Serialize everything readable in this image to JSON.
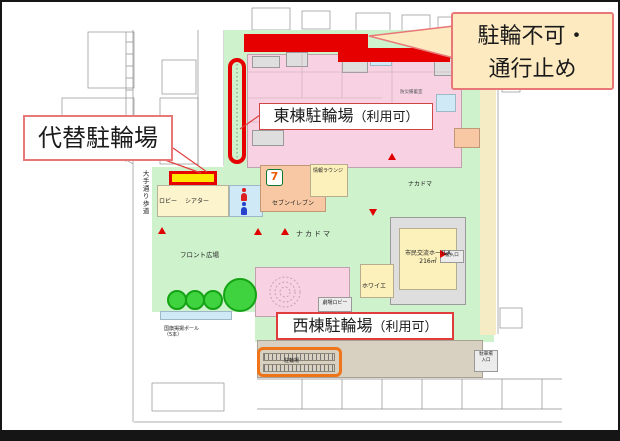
{
  "colors": {
    "alert_red": "#e60000",
    "highlight_yellow": "#ffe600",
    "highlight_orange": "#f07418",
    "callout_bg": "#fdeac1",
    "callout_border": "#e87878",
    "building_pink": "#f8d2e2",
    "ground_green": "#cdf2cc"
  },
  "callouts": {
    "no_parking": {
      "line1": "駐輪不可・",
      "line2": "通行止め"
    },
    "alt_parking": {
      "label": "代替駐輪場"
    },
    "east_parking": {
      "label": "東棟駐輪場",
      "note": "（利用可）"
    },
    "west_parking": {
      "label": "西棟駐輪場",
      "note": "（利用可）"
    }
  },
  "map": {
    "street": "大手通り歩道",
    "labels": {
      "lobby": "ロビー",
      "theater": "シアター",
      "seven_eleven": "セブンイレブン",
      "seven_logo": "7",
      "info_lounge": "情報ラウンジ",
      "nakadoma": "ナカドマ",
      "nakadoma2": "ナカドマ",
      "front_plaza": "フロント広場",
      "flag_poles": "国旗掲揚ポール\n（5本）",
      "civic_hall": "市民交流ホールA\n216㎡",
      "foyer": "ホワイエ",
      "theater_lobby": "劇場ロビー",
      "bike_area": "駐輪場",
      "loading_dock": "搬入口",
      "storage": "防災備蓄室",
      "entrance": "駐車場\n入口"
    }
  }
}
